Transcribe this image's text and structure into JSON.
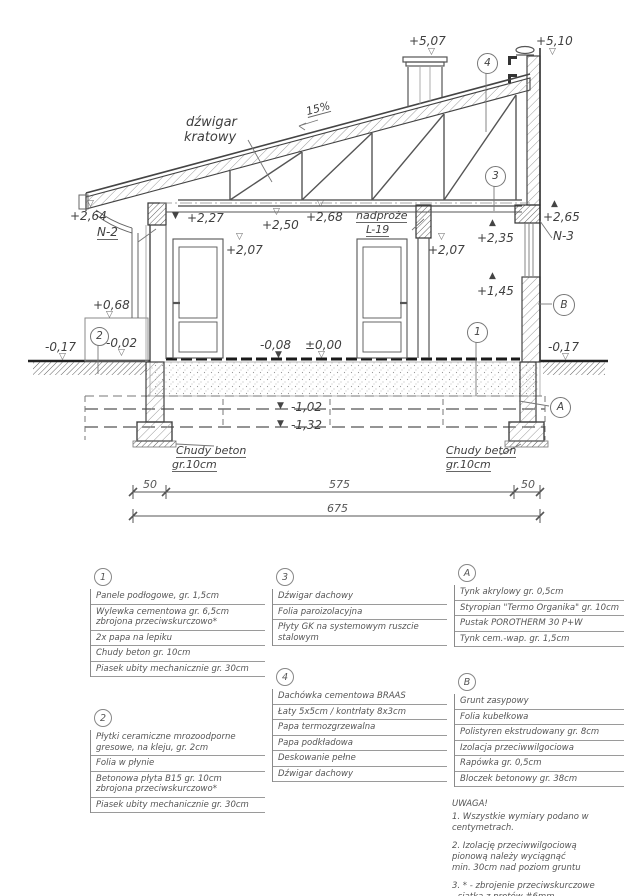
{
  "drawing": {
    "truss1": "dźwigar",
    "truss2": "kratowy",
    "slope": "15%",
    "nadproze1": "nadproże",
    "nadproze2": "L-19",
    "levels": {
      "p507": "+5,07",
      "p510": "+5,10",
      "p264": "+2,64",
      "n2": "N-2",
      "p227": "+2,27",
      "p250": "+2,50",
      "p268": "+2,68",
      "p207_left": "+2,07",
      "p207_right": "+2,07",
      "p235": "+2,35",
      "p265": "+2,65",
      "n3": "N-3",
      "p145": "+1,45",
      "p068": "+0,68",
      "m002": "-0,02",
      "m017_left": "-0,17",
      "m017_right": "-0,17",
      "m008": "-0,08",
      "zero": "±0,00",
      "m102": "-1,02",
      "m132": "-1,32"
    },
    "callouts": {
      "c1": "1",
      "c2": "2",
      "c3": "3",
      "c4": "4",
      "ca": "A",
      "cb": "B"
    },
    "chudy_l1": "Chudy beton",
    "chudy_l2": "gr.10cm",
    "chudy_r1": "Chudy beton",
    "chudy_r2": "gr.10cm",
    "dims": {
      "d50l": "50",
      "d575": "575",
      "d50r": "50",
      "d675": "675"
    }
  },
  "legend": {
    "item1": {
      "id": "1",
      "rows": [
        [
          "Panele podłogowe, gr. 1,5cm"
        ],
        [
          "Wylewka cementowa gr. 6,5cm",
          "zbrojona przeciwskurczowo*"
        ],
        [
          "2x papa na lepiku"
        ],
        [
          "Chudy beton gr. 10cm"
        ],
        [
          "Piasek ubity mechanicznie gr. 30cm"
        ]
      ]
    },
    "item2": {
      "id": "2",
      "rows": [
        [
          "Płytki ceramiczne mrozoodporne",
          "gresowe, na kleju, gr. 2cm"
        ],
        [
          "Folia w płynie"
        ],
        [
          "Betonowa płyta B15 gr. 10cm",
          "zbrojona przeciwskurczowo*"
        ],
        [
          "Piasek ubity mechanicznie gr. 30cm"
        ]
      ]
    },
    "item3": {
      "id": "3",
      "rows": [
        [
          "Dźwigar dachowy"
        ],
        [
          "Folia paroizolacyjna"
        ],
        [
          "Płyty GK na systemowym ruszcie",
          "stalowym"
        ]
      ]
    },
    "item4": {
      "id": "4",
      "rows": [
        [
          "Dachówka cementowa BRAAS"
        ],
        [
          "Łaty 5x5cm / kontrłaty 8x3cm"
        ],
        [
          "Papa termozgrzewalna"
        ],
        [
          "Papa podkładowa"
        ],
        [
          "Deskowanie pełne"
        ],
        [
          "Dźwigar dachowy"
        ]
      ]
    },
    "itemA": {
      "id": "A",
      "rows": [
        [
          "Tynk akrylowy gr. 0,5cm"
        ],
        [
          "Styropian \"Termo Organika\" gr. 10cm"
        ],
        [
          "Pustak POROTHERM 30 P+W"
        ],
        [
          "Tynk cem.-wap. gr. 1,5cm"
        ]
      ]
    },
    "itemB": {
      "id": "B",
      "rows": [
        [
          "Grunt zasypowy"
        ],
        [
          "Folia kubełkowa"
        ],
        [
          "Polistyren ekstrudowany gr. 8cm"
        ],
        [
          "Izolacja przeciwwilgociowa"
        ],
        [
          "Rapówka gr. 0,5cm"
        ],
        [
          "Bloczek betonowy gr. 38cm"
        ]
      ]
    }
  },
  "notes": {
    "title": "UWAGA!",
    "n1": "1. Wszystkie wymiary podano w centymetrach.",
    "n2a": "2. Izolację przeciwwilgociową",
    "n2b": "pionową należy wyciągnąć",
    "n2c": "min. 30cm nad poziom gruntu",
    "n3a": "3. * - zbrojenie przeciwskurczowe",
    "n3b": "- siatka z prętów #6mm",
    "n3c": "o oczkach max. 20x20cm"
  }
}
